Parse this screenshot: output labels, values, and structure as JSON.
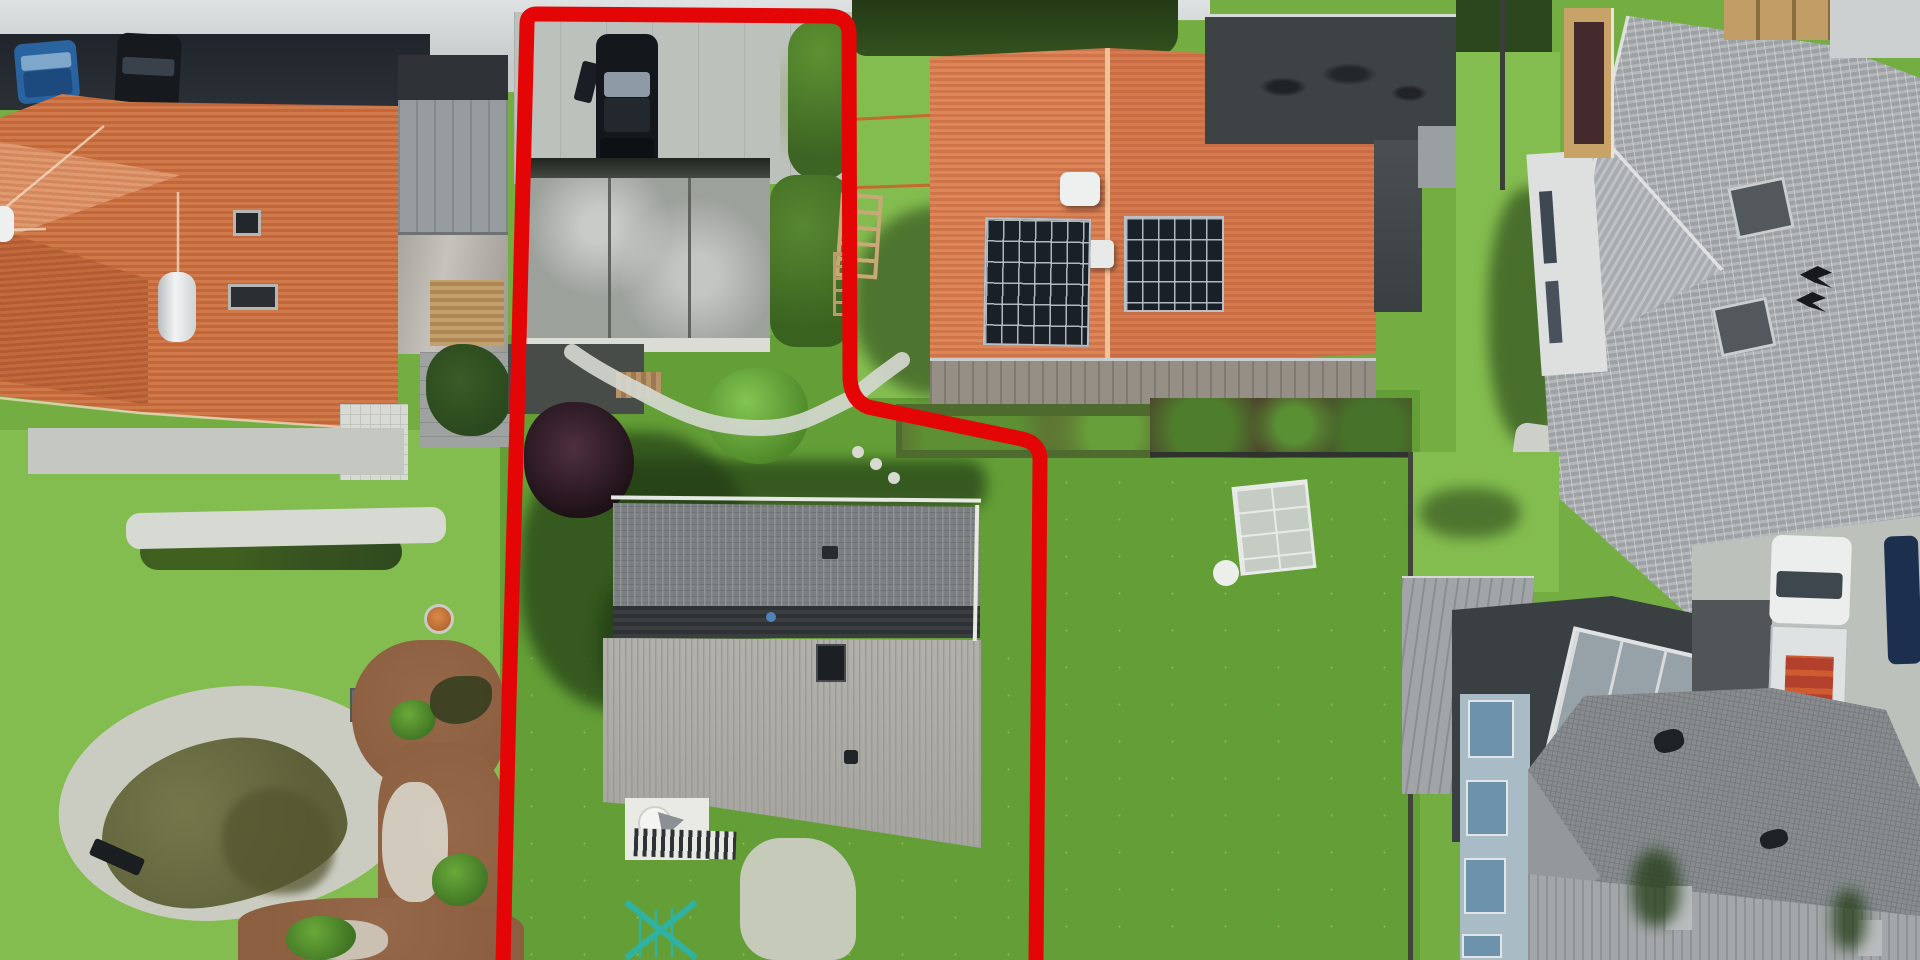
{
  "scene": {
    "type": "aerial-drone-photo",
    "subject": "residential neighborhood with red property boundary outline around center plot",
    "annotation": {
      "name": "property-boundary",
      "color": "#e40606",
      "stroke_width": 15
    },
    "elements": [
      "street",
      "blue-car",
      "black-car-street",
      "orange-hip-roof-house",
      "metal-annex-roof",
      "red-outlined-plot",
      "plot-driveway",
      "parked-dark-car-open-door",
      "gray-garage-roof",
      "garden-path",
      "purple-leaf-tree",
      "gray-gable-roof-house",
      "patio-with-table",
      "clothes-dryer",
      "lawn",
      "pond-with-gravel-ring",
      "bench",
      "mulch-garden",
      "solar-panel-house-orange-roof",
      "solar-arrays",
      "roof-vents",
      "wood-deck",
      "raised-beds",
      "dark-flat-roof-wing",
      "cold-frame",
      "hedge",
      "fence",
      "light-gray-hip-roof-house",
      "chimneys",
      "balcony",
      "planters",
      "deck-terrace",
      "skylight",
      "white-truck-red-cargo",
      "dark-blue-car",
      "dark-gray-hip-roof-house",
      "window-wall"
    ]
  },
  "colors": {
    "red": "#e40606",
    "street": "#c6cacb",
    "streetLight": "#dfe2e2",
    "concrete": "#bdc1bb",
    "hedgeDark": "#2b3037",
    "lawn": "#74ad41",
    "lawnBright": "#84bd4f",
    "lawnLush": "#639f36",
    "flower": "#d9d74a",
    "shadow": "#223c15",
    "tileA": "#c3663a",
    "tileB": "#d07a4b",
    "tileS1": "#d0744a",
    "tileS2": "#dd8659",
    "panel": "#1a2028",
    "carBlue": "#2a64a0",
    "carDark": "#16191d",
    "gravel": "#cbccc1",
    "pond": "#5e6039",
    "mulch": "#8c5f41",
    "flatDark": "#3d4245",
    "cargo": "#b2402c"
  }
}
